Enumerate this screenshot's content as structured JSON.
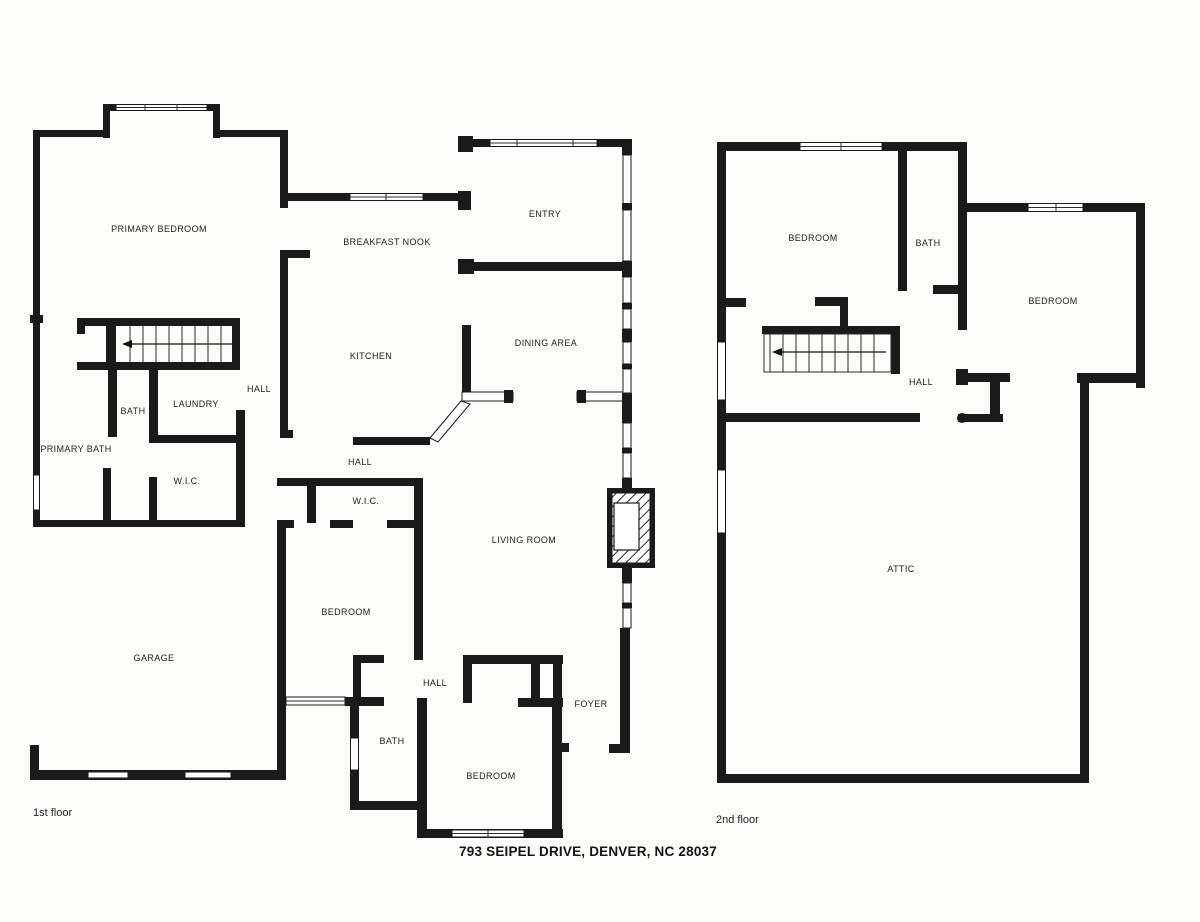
{
  "page": {
    "background": "#fcfcfb",
    "wall_color": "#1a1a1a",
    "line_color": "#2b2b2b"
  },
  "address_caption": "793 SEIPEL DRIVE, DENVER, NC 28037",
  "floor1": {
    "caption": "1st floor",
    "rooms": {
      "primary_bedroom": "PRIMARY BEDROOM",
      "breakfast_nook": "BREAKFAST NOOK",
      "entry": "ENTRY",
      "kitchen": "KITCHEN",
      "dining_area": "DINING AREA",
      "hall_upper": "HALL",
      "bath_upper": "BATH",
      "laundry": "LAUNDRY",
      "primary_bath": "PRIMARY BATH",
      "wic_primary": "W.I.C.",
      "hall_mid": "HALL",
      "wic_mid": "W.I.C.",
      "living_room": "LIVING ROOM",
      "bedroom_mid": "BEDROOM",
      "garage": "GARAGE",
      "hall_lower": "HALL",
      "foyer": "FOYER",
      "bath_lower": "BATH",
      "bedroom_lower": "BEDROOM"
    }
  },
  "floor2": {
    "caption": "2nd floor",
    "rooms": {
      "bedroom_left": "BEDROOM",
      "bath": "BATH",
      "bedroom_right": "BEDROOM",
      "hall": "HALL",
      "attic": "ATTIC"
    }
  }
}
